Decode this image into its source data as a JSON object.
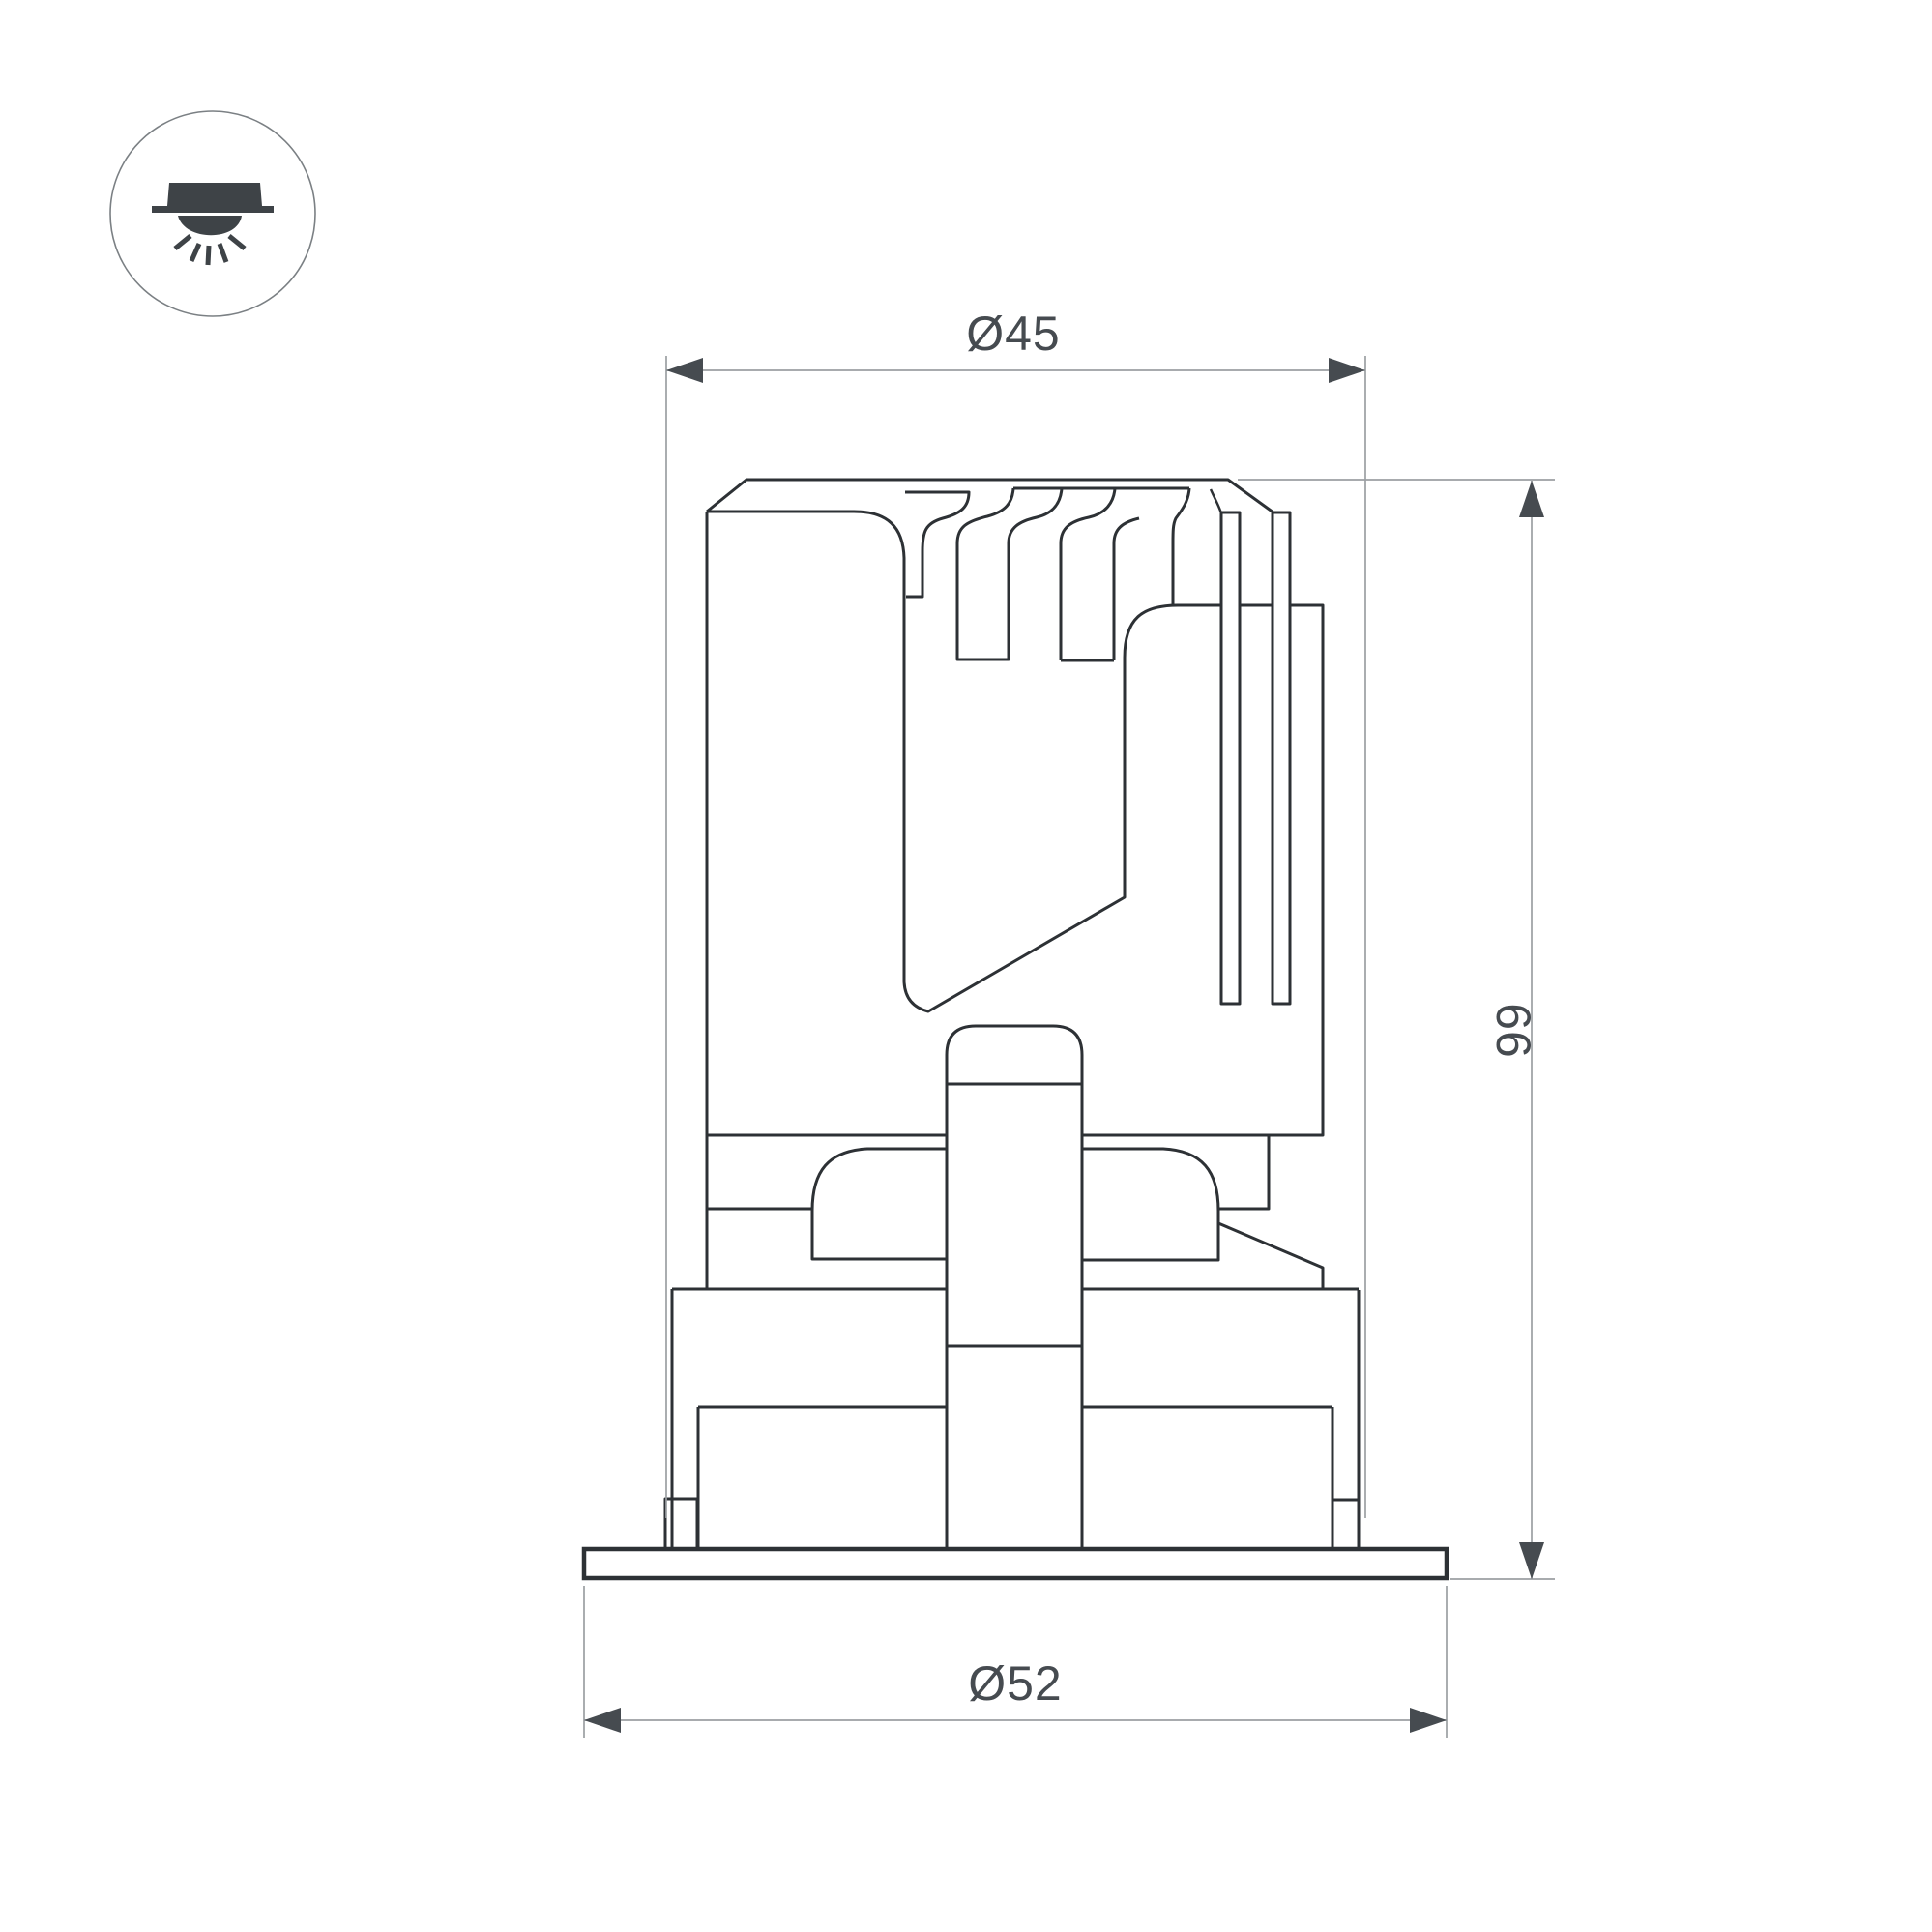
{
  "drawing": {
    "title": "recessed-downlight-section-drawing",
    "colors": {
      "background": "#ffffff",
      "outline": "#2d3135",
      "dimension_line": "#9b9fa3",
      "arrowhead": "#464b50",
      "text": "#464b50",
      "icon_fill": "#3e4347",
      "icon_circle_stroke": "#7b8084"
    },
    "icon": {
      "name": "recessed-ceiling-light-icon"
    },
    "dimensions": {
      "top_diameter": {
        "label": "Ø45",
        "value": 45
      },
      "height": {
        "label": "66",
        "value": 66
      },
      "flange_diameter": {
        "label": "Ø52",
        "value": 52
      }
    }
  }
}
